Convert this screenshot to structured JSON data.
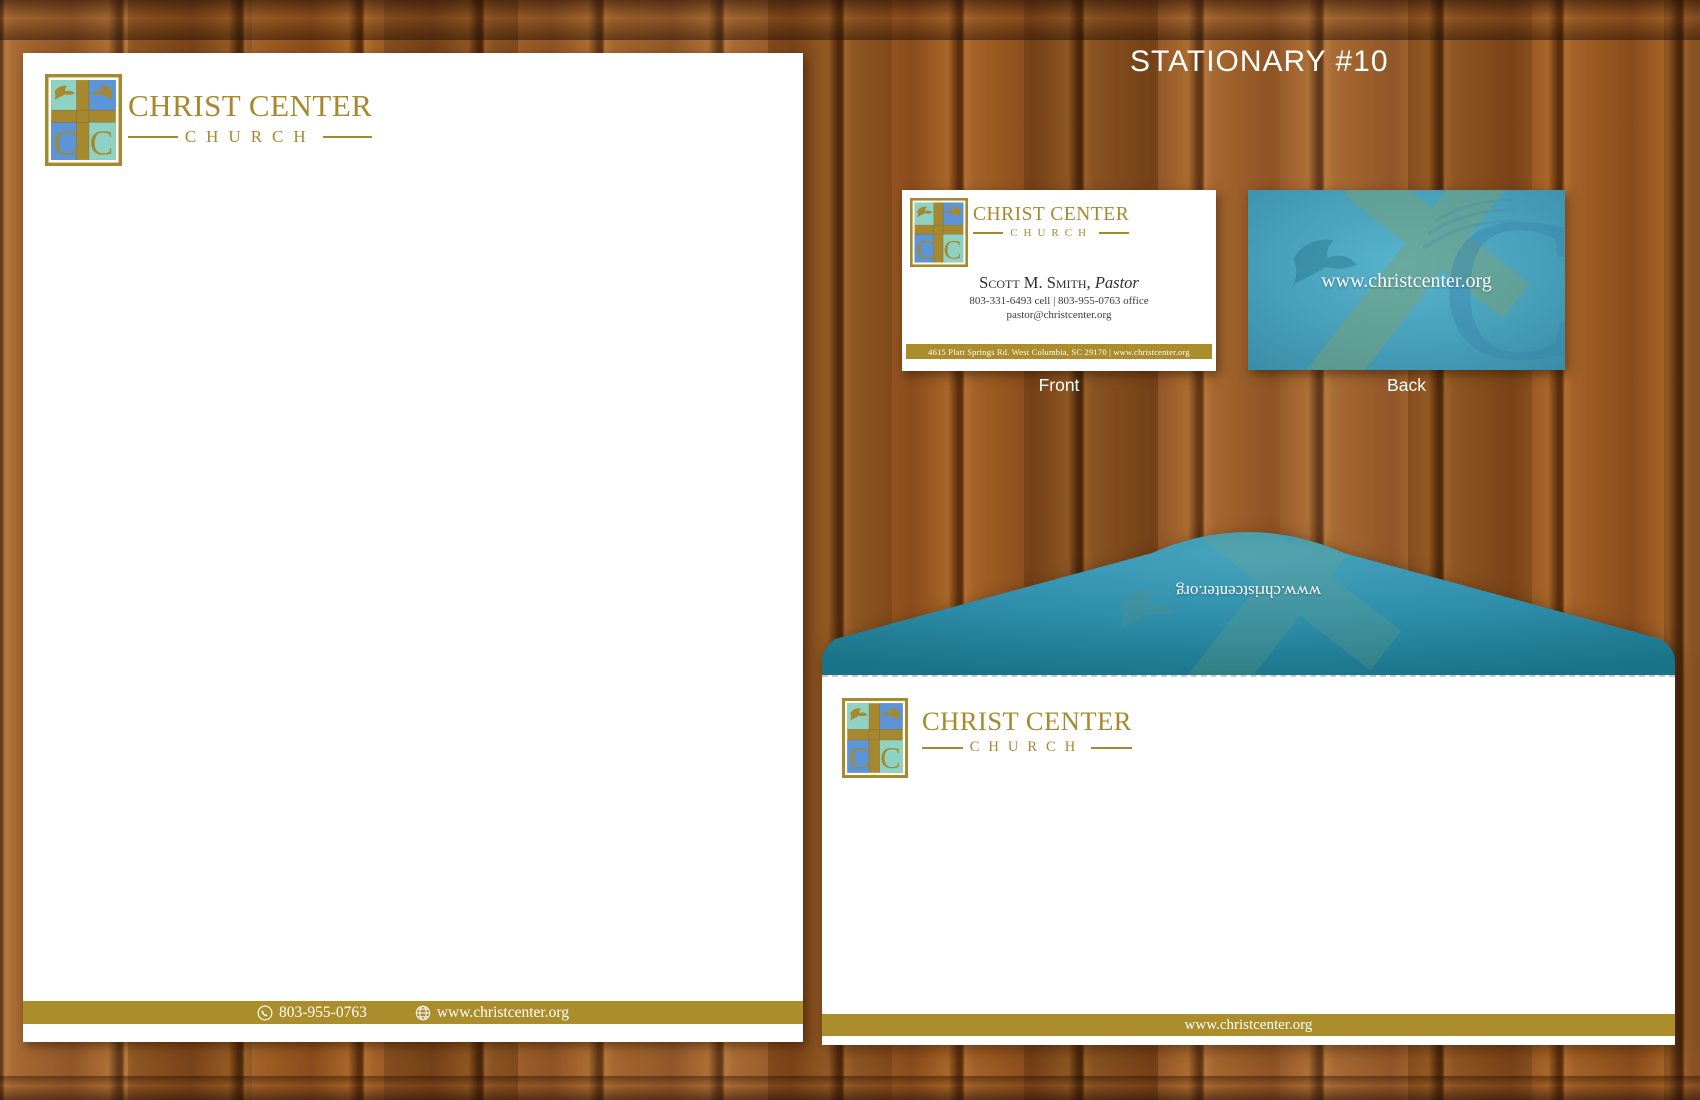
{
  "title": "STATIONARY #10",
  "brand": {
    "line1": "CHRIST CENTER",
    "line2": "CHURCH"
  },
  "letterhead": {
    "phone": "803-955-0763",
    "website": "www.christcenter.org"
  },
  "business_card": {
    "front": {
      "name": "Scott M. Smith,",
      "name_title": "Pastor",
      "phones": "803-331-6493 cell | 803-955-0763 office",
      "email": "pastor@christcenter.org",
      "address_bar": "4615 Platt Springs Rd. West Columbia, SC 29170 | www.christcenter.org",
      "label": "Front"
    },
    "back": {
      "url": "www.christcenter.org",
      "label": "Back"
    }
  },
  "envelope": {
    "flap_url": "www.christcenter.org",
    "footer_url": "www.christcenter.org"
  },
  "colors": {
    "gold": "#a6882f",
    "bar_gold": "#ac8d2c",
    "teal_dark": "#197287",
    "teal_mid": "#2f8fab",
    "teal_light": "#47a3be",
    "card_back_light": "#58b4cd",
    "card_back_base": "#479fba",
    "card_back_deep": "#3a8ca6",
    "logo_aqua": "#8ed2c3",
    "logo_blue": "#5b95d8"
  },
  "icons": {
    "logo": "church-logo",
    "phone": "phone-icon",
    "globe": "globe-icon"
  }
}
